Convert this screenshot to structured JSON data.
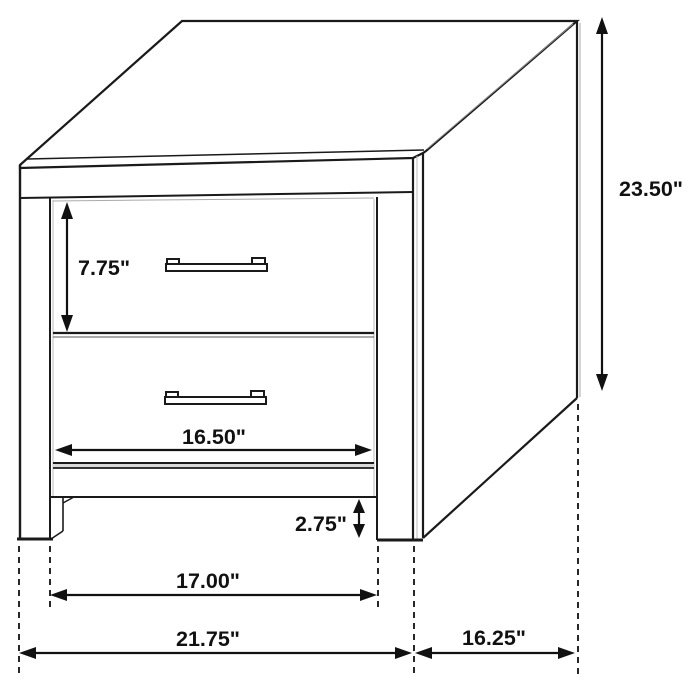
{
  "diagram": {
    "type": "furniture-dimension-drawing",
    "subject": "two-drawer nightstand",
    "unit": "inches",
    "labels": {
      "overall_height": "23.50\"",
      "top_drawer_height": "7.75\"",
      "drawer_width": "16.50\"",
      "base_clearance": "2.75\"",
      "inner_leg_span": "17.00\"",
      "overall_width": "21.75\"",
      "depth": "16.25\""
    },
    "colors": {
      "line": "#1a1a1a",
      "dimension": "#111111",
      "background": "#ffffff",
      "shading": "#d9d9d9"
    }
  }
}
